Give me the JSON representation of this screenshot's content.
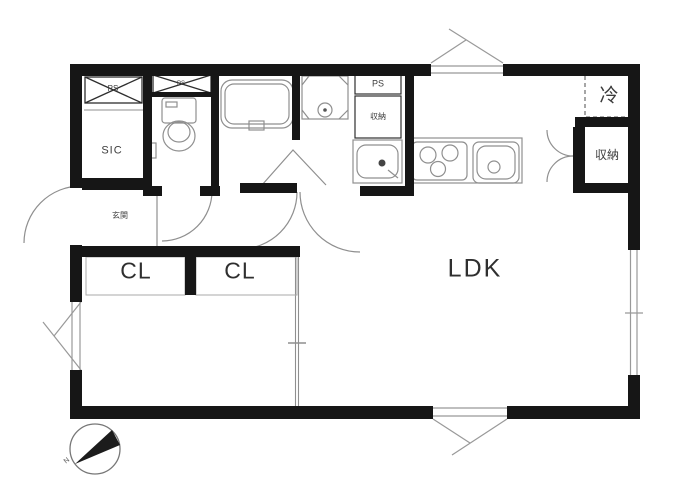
{
  "floorplan": {
    "labels": {
      "meter_box_left": "PS",
      "meter_box_small": "PS",
      "shoe_closet": "SIC",
      "entrance": "玄関",
      "pipe_space": "PS",
      "storage_washroom": "収納",
      "refrigerator": "冷",
      "storage_kitchen": "収納",
      "living_dining_kitchen": "LDK",
      "closet_left": "CL",
      "closet_right": "CL"
    },
    "compass": {
      "north": "N"
    },
    "colors": {
      "wall": "#161616",
      "thin_line": "#8f8f8f",
      "text": "#3c3c3c"
    }
  }
}
